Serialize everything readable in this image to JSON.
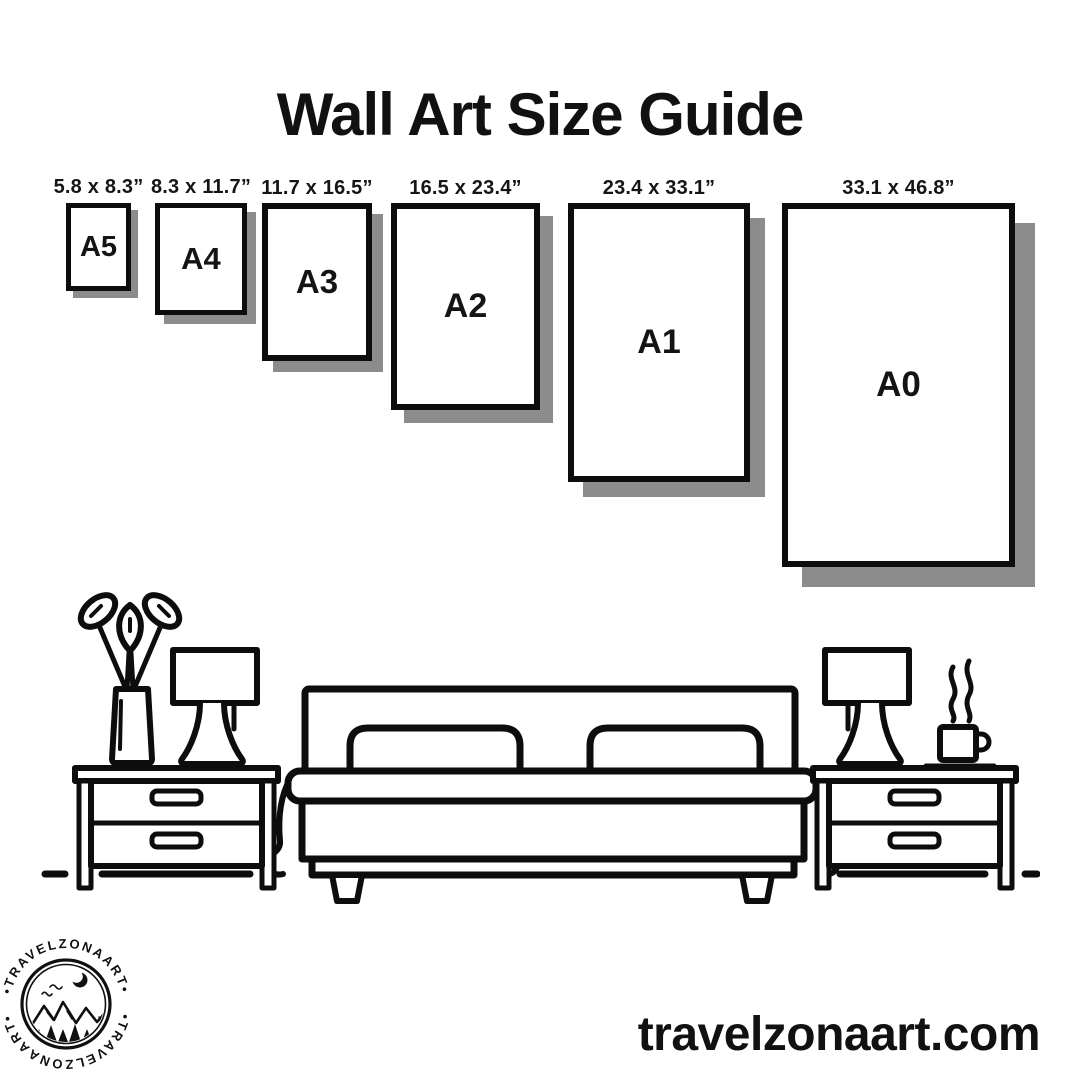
{
  "page": {
    "background_color": "#ffffff",
    "ink_color": "#0d0d0d",
    "shadow_color": "#8c8c8c"
  },
  "header": {
    "title": "Wall Art Size Guide"
  },
  "size_guide": {
    "sizes": [
      {
        "label": "A5",
        "dimensions": "5.8 x 8.3”"
      },
      {
        "label": "A4",
        "dimensions": "8.3 x 11.7”"
      },
      {
        "label": "A3",
        "dimensions": "11.7 x 16.5”"
      },
      {
        "label": "A2",
        "dimensions": "16.5 x 23.4”"
      },
      {
        "label": "A1",
        "dimensions": "23.4 x 33.1”"
      },
      {
        "label": "A0",
        "dimensions": "33.1 x 46.8”"
      }
    ]
  },
  "scene": {
    "description": "line-art bedroom: plant vase, table lamp and nightstand, double bed with two pillows, nightstand with table lamp and steaming coffee mug",
    "icons": [
      "plant-vase-icon",
      "table-lamp-icon",
      "nightstand-icon",
      "double-bed-icon",
      "pillow-icon",
      "coffee-mug-icon"
    ]
  },
  "logo": {
    "ring_text": "•TRAVELZONAART•",
    "brand": "TRAVELZONAART",
    "icons": [
      "crescent-moon-icon",
      "birds-icon",
      "mountains-icon",
      "pine-trees-icon",
      "water-icon"
    ]
  },
  "footer": {
    "website": "travelzonaart.com"
  }
}
